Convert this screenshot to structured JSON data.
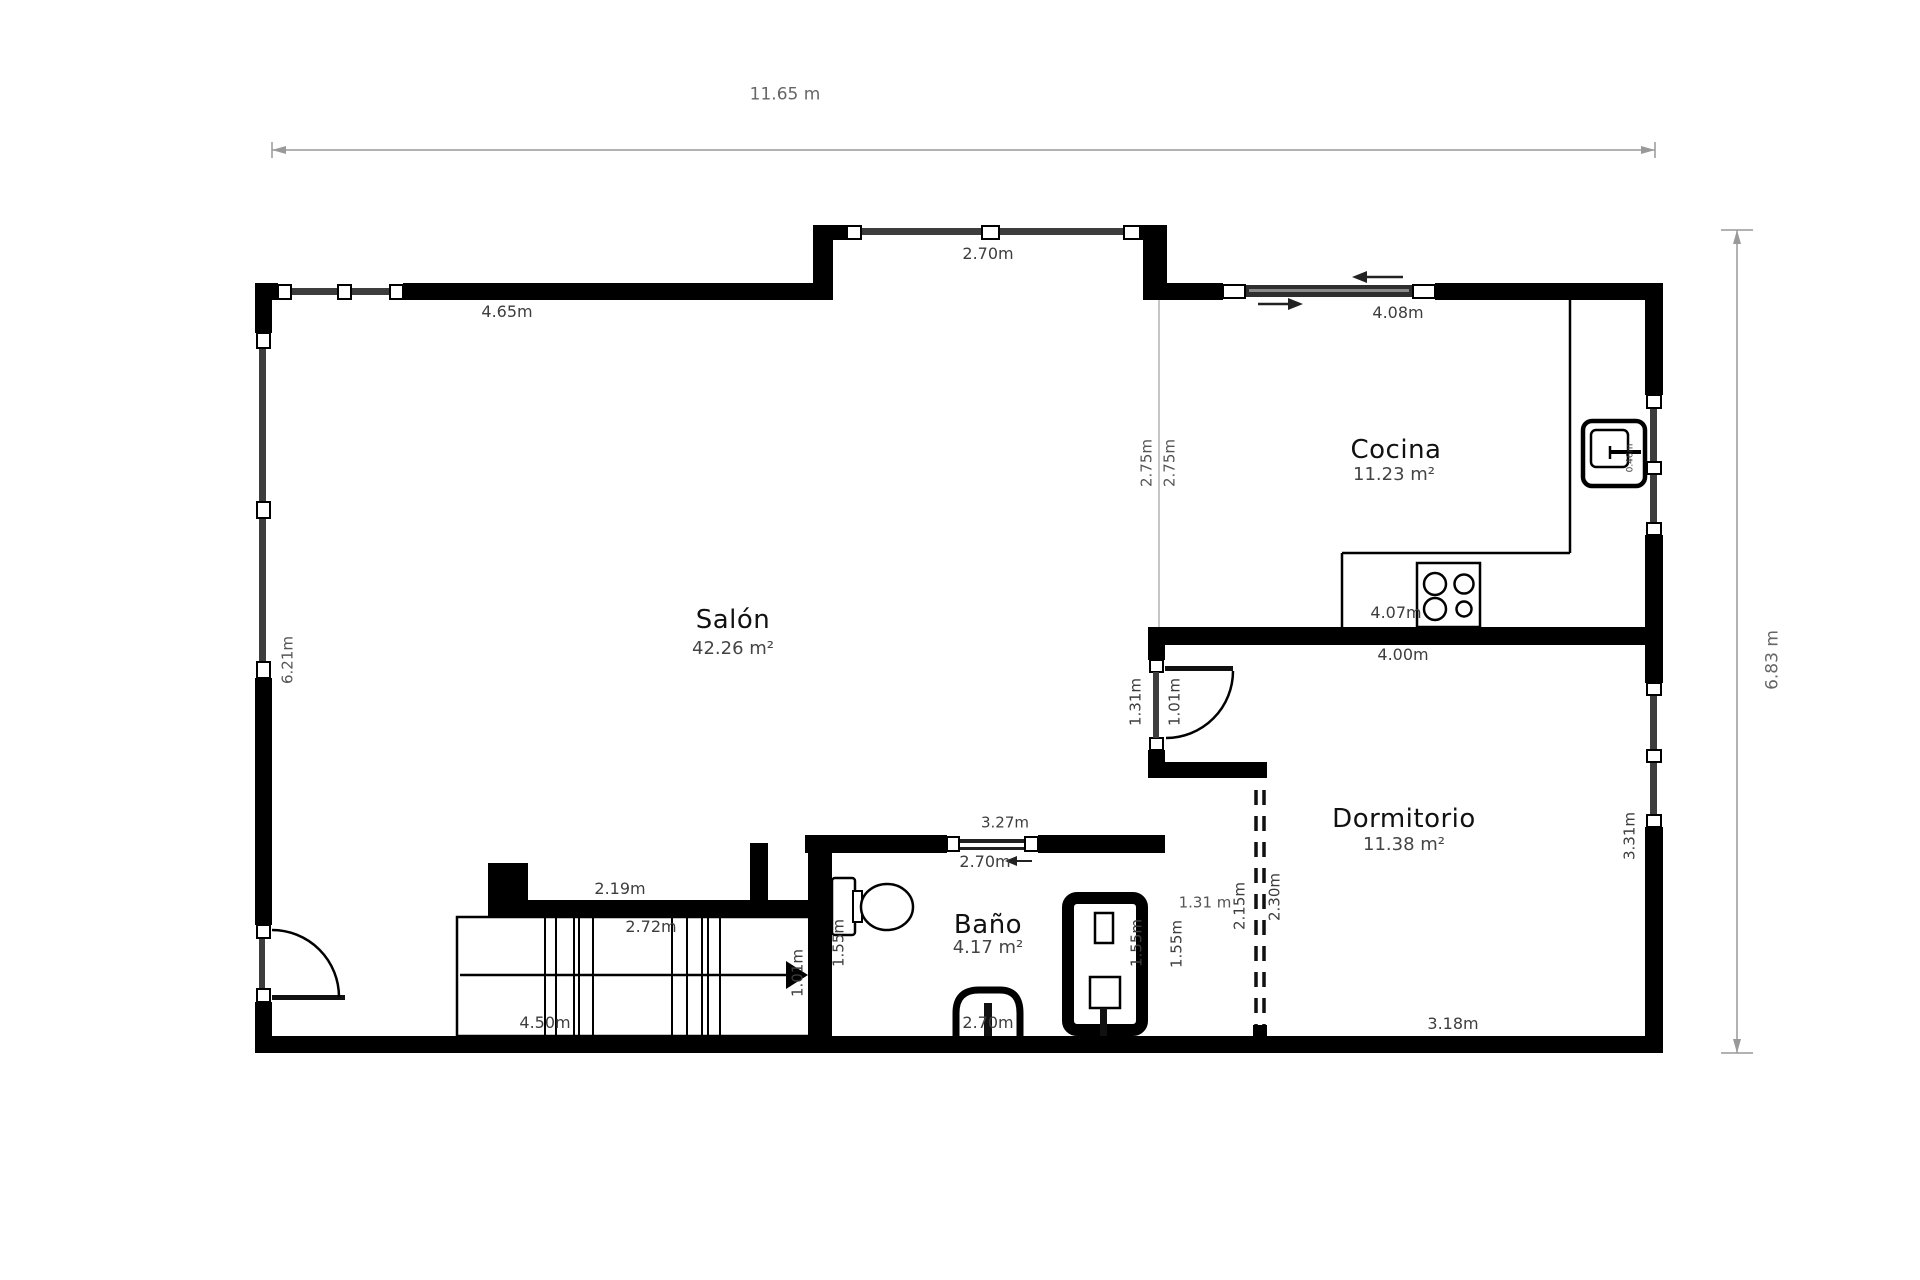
{
  "floor_plan": {
    "type": "apartment-floor-plan",
    "overall_dimensions": {
      "width": "11.65 m",
      "height": "6.83 m"
    },
    "rooms": [
      {
        "name": "Salón",
        "area": "42.26 m²"
      },
      {
        "name": "Cocina",
        "area": "11.23 m²"
      },
      {
        "name": "Baño",
        "area": "4.17 m²"
      },
      {
        "name": "Dormitorio",
        "area": "11.38 m²"
      }
    ],
    "colors": {
      "wall": "#000000",
      "glass": "#3d3d3d",
      "dim_line": "#999999",
      "dim_text": "#444444",
      "room_text": "#111111"
    },
    "labels": [
      {
        "name": "dim-total-width",
        "text": "11.65 m",
        "x": 785,
        "y": 95,
        "fs": 17,
        "color": "#666666"
      },
      {
        "name": "dim-top-left-wall",
        "text": "4.65m",
        "x": 507,
        "y": 312,
        "fs": 16,
        "color": "#3d3d3d"
      },
      {
        "name": "dim-bay-window",
        "text": "2.70m",
        "x": 988,
        "y": 254,
        "fs": 16,
        "color": "#3d3d3d"
      },
      {
        "name": "dim-top-right-wall",
        "text": "4.08m",
        "x": 1398,
        "y": 313,
        "fs": 16,
        "color": "#3d3d3d"
      },
      {
        "name": "dim-kitchen-open-left",
        "text": "2.75m",
        "x": 1147,
        "y": 463,
        "fs": 15,
        "rot": 1,
        "color": "#555555"
      },
      {
        "name": "dim-kitchen-open-right",
        "text": "2.75m",
        "x": 1170,
        "y": 463,
        "fs": 15,
        "rot": 1,
        "color": "#555555"
      },
      {
        "name": "room-cocina",
        "text": "Cocina",
        "x": 1396,
        "y": 450,
        "fs": 26,
        "color": "#111111",
        "room": 1
      },
      {
        "name": "area-cocina",
        "text": "11.23 m²",
        "x": 1394,
        "y": 475,
        "fs": 18,
        "color": "#444444"
      },
      {
        "name": "dim-kitchen-sink",
        "text": "0.46m",
        "x": 1631,
        "y": 458,
        "fs": 9,
        "rot": 1,
        "color": "#3d3d3d"
      },
      {
        "name": "room-salon",
        "text": "Salón",
        "x": 733,
        "y": 620,
        "fs": 26,
        "color": "#111111",
        "room": 1
      },
      {
        "name": "area-salon",
        "text": "42.26 m²",
        "x": 733,
        "y": 649,
        "fs": 18,
        "color": "#444444"
      },
      {
        "name": "dim-left-wall",
        "text": "6.21m",
        "x": 288,
        "y": 660,
        "fs": 15,
        "rot": 1,
        "color": "#555555"
      },
      {
        "name": "dim-total-height",
        "text": "6.83 m",
        "x": 1773,
        "y": 660,
        "fs": 17,
        "rot": 1,
        "color": "#666666"
      },
      {
        "name": "dim-kitchen-counter",
        "text": "4.07m",
        "x": 1396,
        "y": 613,
        "fs": 16,
        "color": "#3d3d3d"
      },
      {
        "name": "dim-bedroom-top-wall",
        "text": "4.00m",
        "x": 1403,
        "y": 655,
        "fs": 16,
        "color": "#3d3d3d"
      },
      {
        "name": "dim-hall-wall",
        "text": "1.31m",
        "x": 1136,
        "y": 702,
        "fs": 15,
        "rot": 1,
        "color": "#3d3d3d"
      },
      {
        "name": "dim-bedroom-door",
        "text": "1.01m",
        "x": 1175,
        "y": 702,
        "fs": 15,
        "rot": 1,
        "color": "#3d3d3d"
      },
      {
        "name": "room-dormitorio",
        "text": "Dormitorio",
        "x": 1404,
        "y": 819,
        "fs": 26,
        "color": "#111111",
        "room": 1
      },
      {
        "name": "area-dormitorio",
        "text": "11.38 m²",
        "x": 1404,
        "y": 845,
        "fs": 18,
        "color": "#444444"
      },
      {
        "name": "dim-bath-top-wall",
        "text": "3.27m",
        "x": 1005,
        "y": 823,
        "fs": 15,
        "color": "#3d3d3d"
      },
      {
        "name": "dim-bath-window",
        "text": "2.70m",
        "x": 985,
        "y": 862,
        "fs": 16,
        "color": "#3d3d3d"
      },
      {
        "name": "dim-closet-opening",
        "text": "2.19m",
        "x": 620,
        "y": 889,
        "fs": 16,
        "color": "#3d3d3d"
      },
      {
        "name": "dim-stairs-upper",
        "text": "2.72m",
        "x": 651,
        "y": 927,
        "fs": 16,
        "color": "#3d3d3d"
      },
      {
        "name": "room-bano",
        "text": "Baño",
        "x": 988,
        "y": 925,
        "fs": 26,
        "color": "#111111",
        "room": 1
      },
      {
        "name": "area-bano",
        "text": "4.17 m²",
        "x": 988,
        "y": 948,
        "fs": 18,
        "color": "#444444"
      },
      {
        "name": "dim-bath-depth",
        "text": "1.55m",
        "x": 839,
        "y": 943,
        "fs": 15,
        "rot": 1,
        "color": "#3d3d3d"
      },
      {
        "name": "dim-shower-inner",
        "text": "1.55m",
        "x": 1137,
        "y": 943,
        "fs": 15,
        "rot": 1,
        "color": "#3d3d3d"
      },
      {
        "name": "dim-shower-outer",
        "text": "1.55m",
        "x": 1177,
        "y": 944,
        "fs": 15,
        "rot": 1,
        "color": "#3d3d3d"
      },
      {
        "name": "dim-hall-width",
        "text": "1.31 m",
        "x": 1205,
        "y": 903,
        "fs": 15,
        "color": "#555555"
      },
      {
        "name": "dim-partition-left",
        "text": "2.15m",
        "x": 1240,
        "y": 906,
        "fs": 15,
        "rot": 1,
        "color": "#3d3d3d"
      },
      {
        "name": "dim-partition-right",
        "text": "2.30m",
        "x": 1275,
        "y": 897,
        "fs": 15,
        "rot": 1,
        "color": "#3d3d3d"
      },
      {
        "name": "dim-stairs-arrow",
        "text": "1.01m",
        "x": 798,
        "y": 973,
        "fs": 15,
        "rot": 1,
        "color": "#3d3d3d"
      },
      {
        "name": "dim-stairs-lower",
        "text": "4.50m",
        "x": 545,
        "y": 1023,
        "fs": 16,
        "color": "#3d3d3d"
      },
      {
        "name": "dim-bath-bottom",
        "text": "2.70m",
        "x": 988,
        "y": 1023,
        "fs": 16,
        "color": "#3d3d3d"
      },
      {
        "name": "dim-bedroom-bottom",
        "text": "3.18m",
        "x": 1453,
        "y": 1024,
        "fs": 16,
        "color": "#3d3d3d"
      },
      {
        "name": "dim-bedroom-right",
        "text": "3.31m",
        "x": 1630,
        "y": 836,
        "fs": 15,
        "rot": 1,
        "color": "#3d3d3d"
      }
    ]
  }
}
